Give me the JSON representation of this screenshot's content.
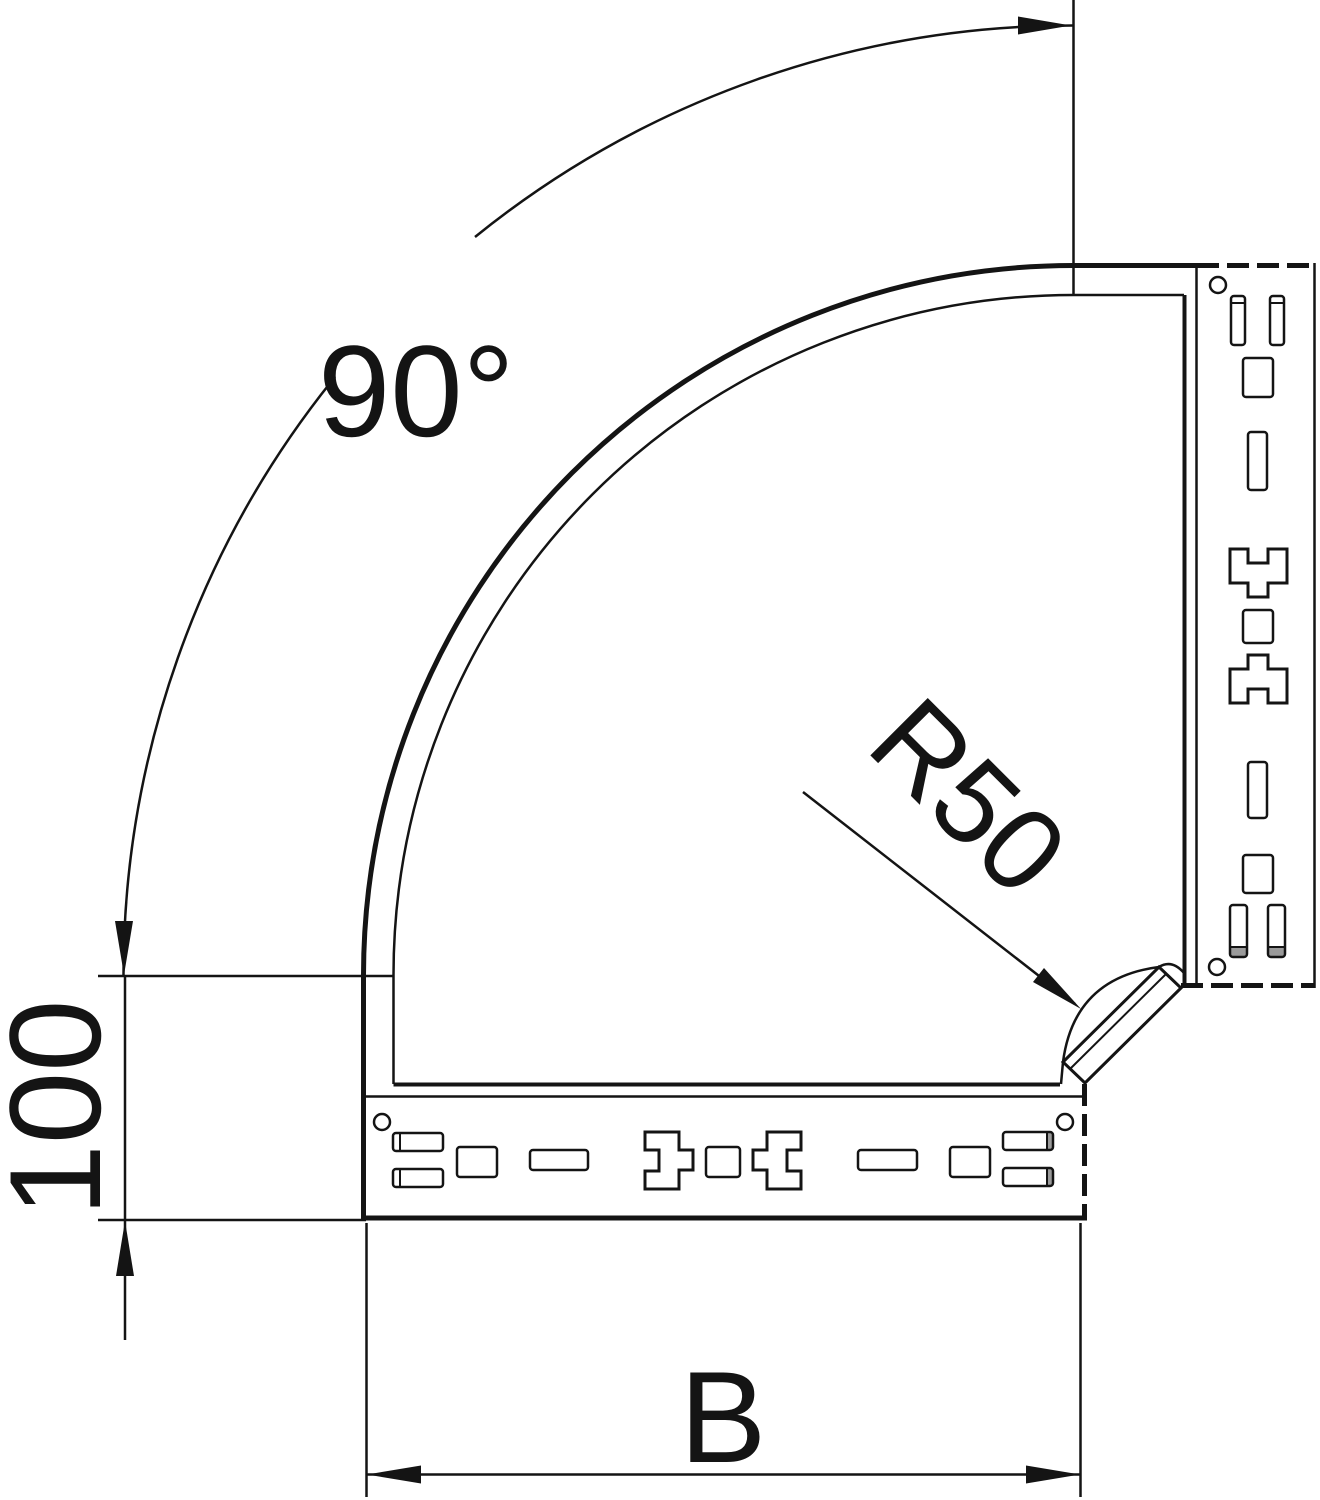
{
  "drawing": {
    "title": "90 degree cable tray bend - dimensioned plan view",
    "type": "technical-line-drawing",
    "labels": {
      "angle": "90°",
      "radius": "R50",
      "end_length": "100",
      "width": "B"
    },
    "dimension_values": {
      "bend_angle_deg": 90,
      "inner_radius_mm": 50,
      "straight_end_mm": 100,
      "width_symbol": "B"
    },
    "colors": {
      "line": "#141414",
      "background": "#ffffff",
      "slot_shading": "#9a9a9a"
    },
    "features": {
      "perforated_rails": 2,
      "screw_holes_per_rail": 2,
      "corner": "45-degree chamfer plate with R50 inner fillet"
    }
  }
}
